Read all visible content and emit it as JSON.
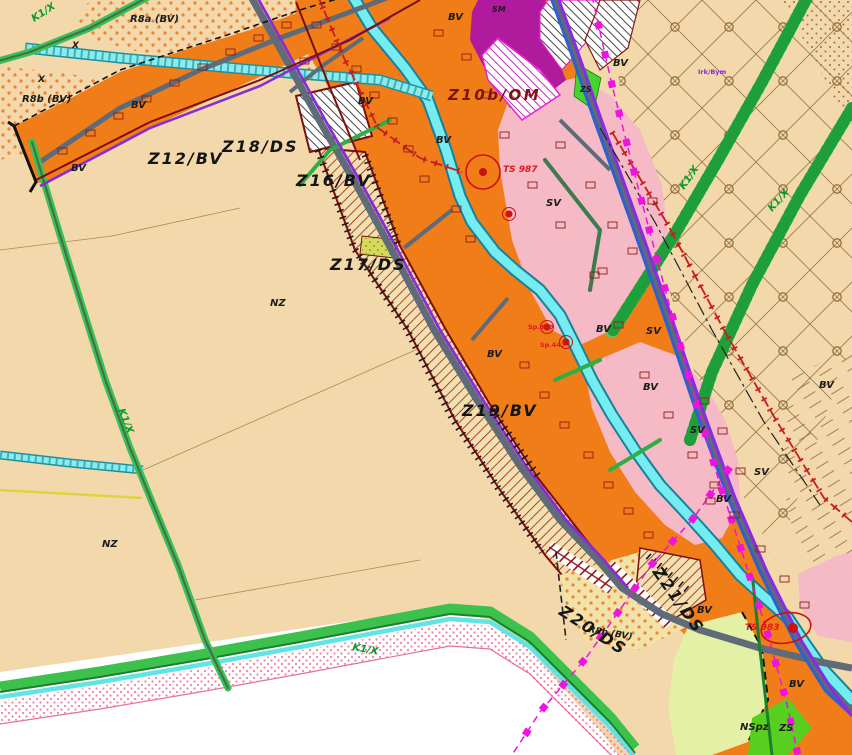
{
  "map": {
    "labels": {
      "k1x": "K1/X",
      "r8a": "R8a (BV)",
      "r8b": "R8b (BV)",
      "x": "X",
      "z12": "Z12/BV",
      "z18": "Z18/DS",
      "z16": "Z16/BV",
      "z17": "Z17/DS",
      "z19": "Z19/BV",
      "z20": "Z20/DS",
      "z21": "Z21/DS",
      "z10b": "Z10b/OM",
      "bv": "BV",
      "sv": "SV",
      "nz": "NZ",
      "sm": "SM",
      "zs": "ZS",
      "nspz": "NSpz",
      "ts987": "TS 987",
      "ts983": "TS 983",
      "sp349": "Sp.349",
      "sp447": "Sp.447",
      "parcel": "Irk/Bym"
    },
    "colors": {
      "bv_orange": "#f07d18",
      "sv_pink": "#f6b9c6",
      "sm_purple": "#b01a9c",
      "zs_green": "#44d62c",
      "nspz_light_green": "#e4f0a6",
      "nz_beige": "#f2d8ab",
      "water_cyan": "#7deff0",
      "road_gray": "#5f6b78",
      "green_road": "#36c451",
      "ds_hatch_red": "#9c2a1a",
      "zone_boundary_dark_red": "#7b0f0f",
      "utility_magenta": "#f012e0",
      "power_line_red": "#c41e1e"
    }
  }
}
